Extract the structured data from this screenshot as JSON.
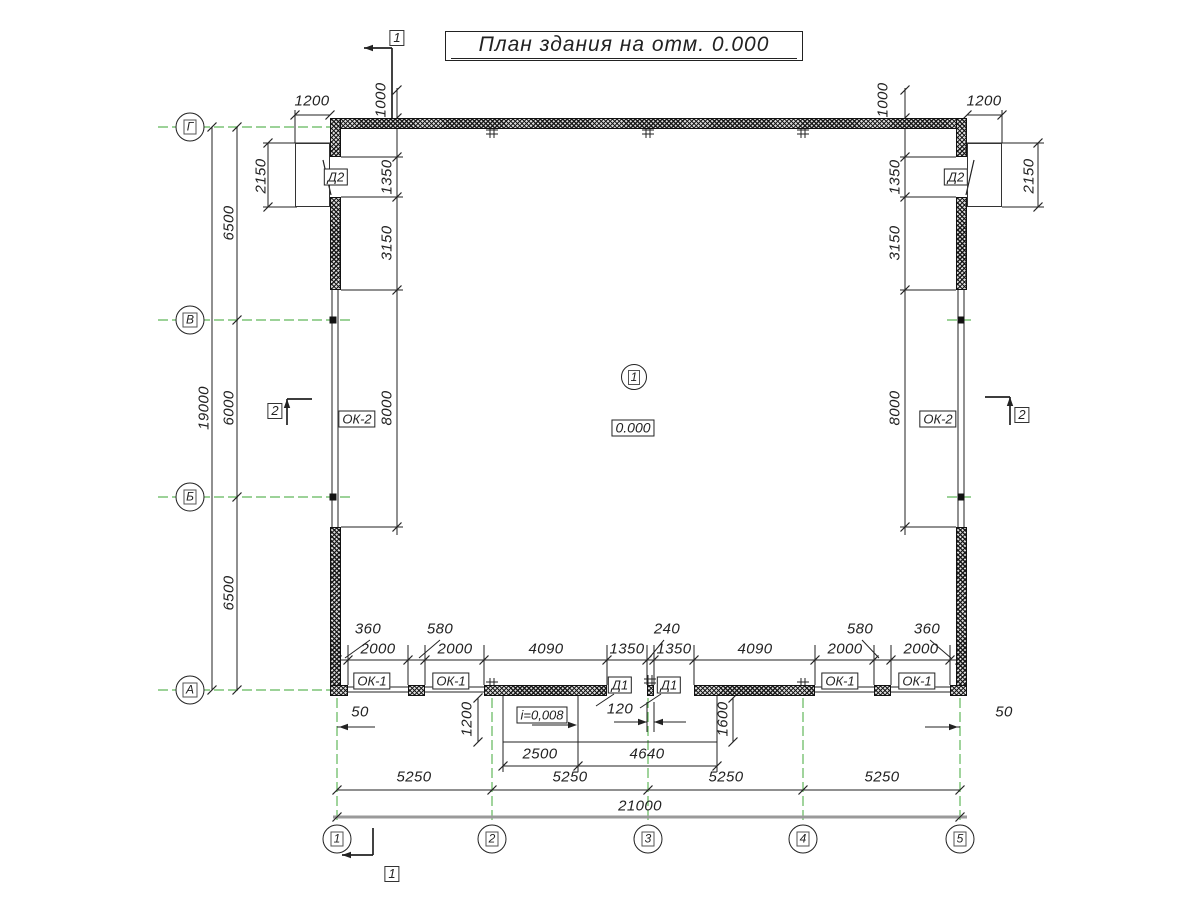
{
  "title": "План здания на отм. 0.000",
  "axes": {
    "rows": [
      "Г",
      "В",
      "Б",
      "А"
    ],
    "cols": [
      "1",
      "2",
      "3",
      "4",
      "5"
    ]
  },
  "sections": {
    "one": "1",
    "two": "2"
  },
  "room": {
    "number": "1",
    "elevation": "0.000"
  },
  "labels": {
    "door_side": "Д2",
    "door_entrance": "Д1",
    "window_small": "ОК-1",
    "window_large": "ОК-2",
    "slope": "i=0,008"
  },
  "dims": {
    "left": {
      "porch_width": "1200",
      "top_offset": "1000",
      "porch_height": "2150",
      "span_gv": "6500",
      "door": "1350",
      "pier": "3150",
      "span_vb": "6000",
      "window": "8000",
      "span_ba": "6500",
      "total": "19000"
    },
    "right": {
      "porch_width": "1200",
      "top_offset": "1000",
      "porch_height": "2150",
      "door": "1350",
      "pier": "3150",
      "window": "8000"
    },
    "bottom": {
      "corner_l": "360",
      "pier_l": "580",
      "center_pier": "240",
      "pier_r": "580",
      "corner_r": "360",
      "chain": [
        "2000",
        "2000",
        "4090",
        "1350",
        "1350",
        "4090",
        "2000",
        "2000"
      ],
      "edge_l": "50",
      "edge_r": "50",
      "ramp_depth": "1200",
      "axis_to_jamb": "120",
      "platform_depth": "1600",
      "ramp_width": "2500",
      "platform_width": "4640",
      "spans": [
        "5250",
        "5250",
        "5250",
        "5250"
      ],
      "total": "21000"
    }
  },
  "colors": {
    "axis_green": "#62b85a",
    "line": "#222222",
    "dim_gray": "#9a9a9a"
  }
}
